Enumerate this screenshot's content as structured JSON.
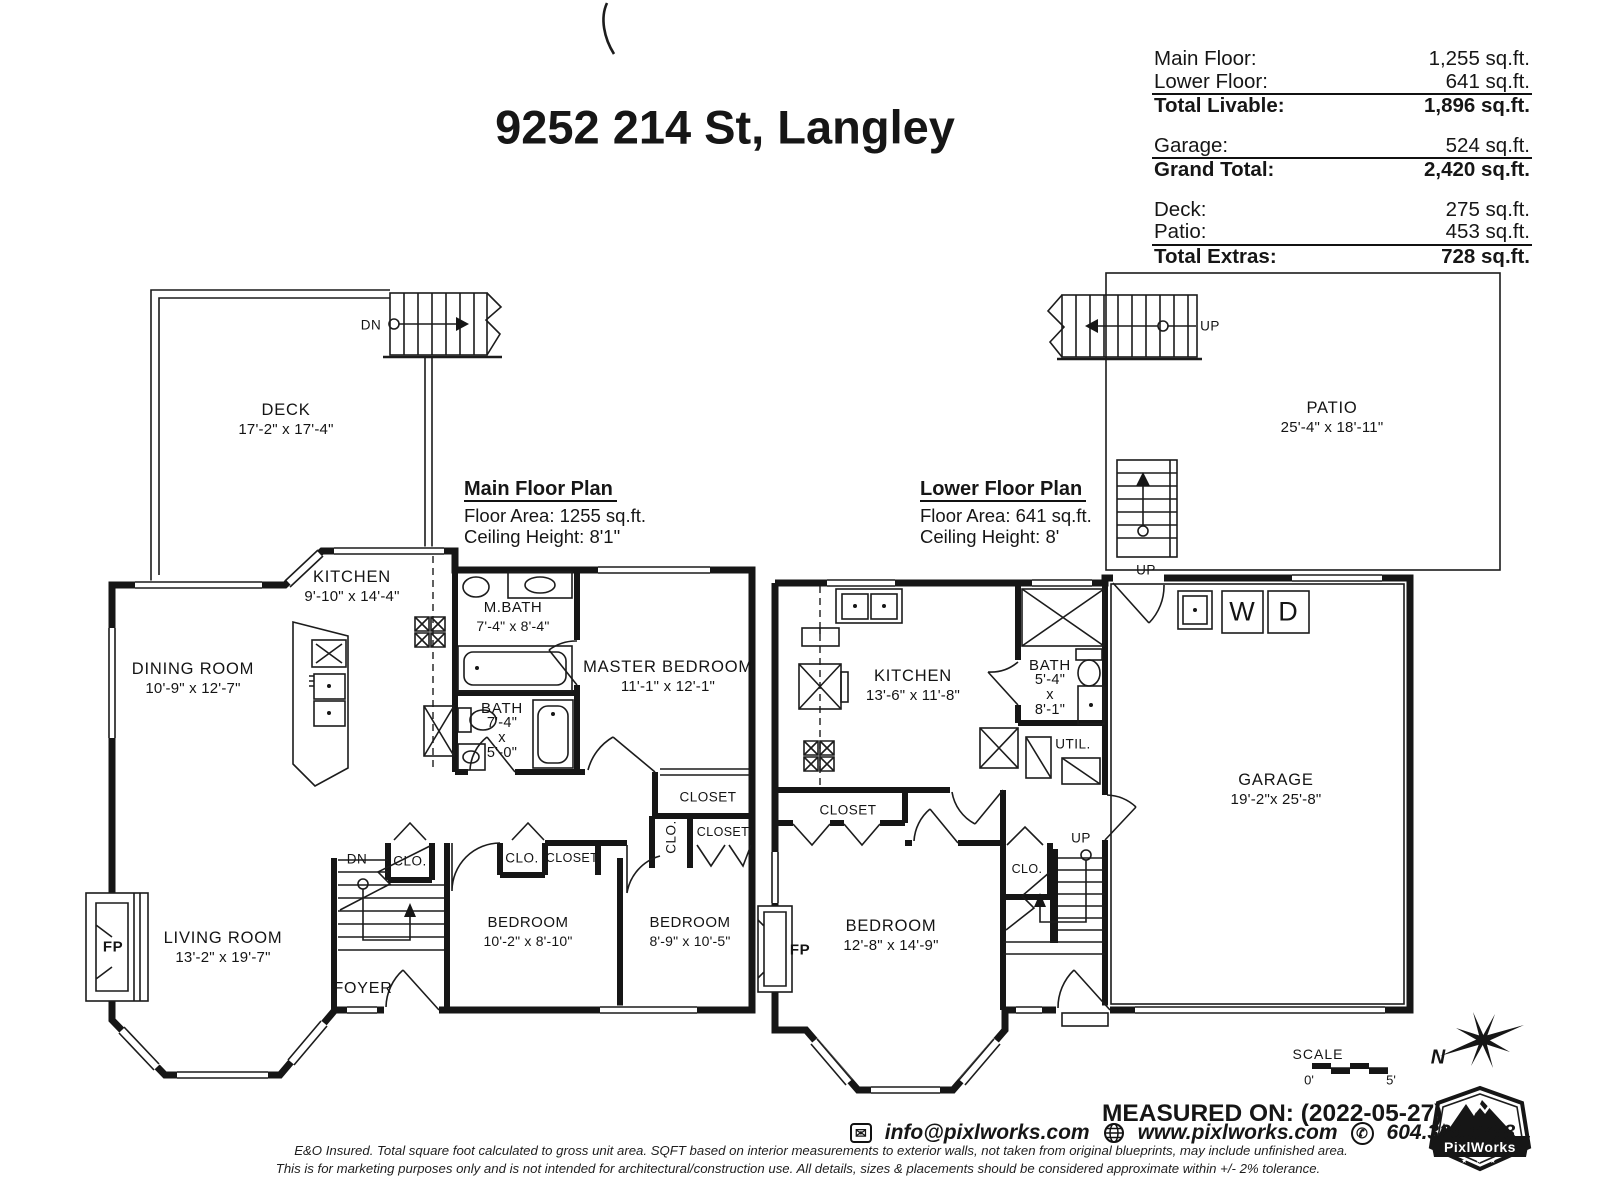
{
  "page": {
    "title": "9252 214 St, Langley"
  },
  "summary": {
    "rows": [
      {
        "label": "Main Floor:",
        "value": "1,255 sq.ft."
      },
      {
        "label": "Lower Floor:",
        "value": "641 sq.ft."
      },
      {
        "label": "Total Livable:",
        "value": "1,896 sq.ft."
      },
      {
        "label": "Garage:",
        "value": "524 sq.ft."
      },
      {
        "label": "Grand Total:",
        "value": "2,420 sq.ft."
      },
      {
        "label": "Deck:",
        "value": "275 sq.ft."
      },
      {
        "label": "Patio:",
        "value": "453 sq.ft."
      },
      {
        "label": "Total Extras:",
        "value": "728 sq.ft."
      }
    ]
  },
  "main_floor": {
    "heading": "Main Floor Plan",
    "floor_area": "Floor Area: 1255 sq.ft.",
    "ceiling_height": "Ceiling Height: 8'1\"",
    "rooms": {
      "deck": {
        "name": "DECK",
        "dims": "17'-2\" x 17'-4\""
      },
      "kitchen": {
        "name": "KITCHEN",
        "dims": "9'-10\" x 14'-4\""
      },
      "dining_room": {
        "name": "DINING ROOM",
        "dims": "10'-9\" x 12'-7\""
      },
      "m_bath": {
        "name": "M.BATH",
        "dims": "7'-4\" x 8'-4\""
      },
      "bath": {
        "name": "BATH",
        "dim_w": "7'-4\"",
        "dim_sep": "x",
        "dim_h": "5'-0\""
      },
      "master_bedroom": {
        "name": "MASTER BEDROOM",
        "dims": "11'-1\" x 12'-1\""
      },
      "living_room": {
        "name": "LIVING ROOM",
        "dims": "13'-2\" x 19'-7\""
      },
      "bedroom_a": {
        "name": "BEDROOM",
        "dims": "10'-2\" x 8'-10\""
      },
      "bedroom_b": {
        "name": "BEDROOM",
        "dims": "8'-9\" x 10'-5\""
      },
      "foyer": {
        "name": "FOYER"
      }
    }
  },
  "lower_floor": {
    "heading": "Lower Floor Plan",
    "floor_area": "Floor Area: 641 sq.ft.",
    "ceiling_height": "Ceiling Height: 8'",
    "rooms": {
      "patio": {
        "name": "PATIO",
        "dims": "25'-4\" x 18'-11\""
      },
      "kitchen": {
        "name": "KITCHEN",
        "dims": "13'-6\" x 11'-8\""
      },
      "bath": {
        "name": "BATH",
        "dim_w": "5'-4\"",
        "dim_sep": "x",
        "dim_h": "8'-1\""
      },
      "garage": {
        "name": "GARAGE",
        "dims": "19'-2\"x 25'-8\""
      },
      "bedroom": {
        "name": "BEDROOM",
        "dims": "12'-8\" x 14'-9\""
      }
    }
  },
  "tags": {
    "closet": "CLOSET",
    "clo": "CLO.",
    "dn": "DN",
    "up": "UP",
    "fp": "FP",
    "util": "UTIL.",
    "washer": "W",
    "dryer": "D"
  },
  "scale": {
    "label": "SCALE",
    "start": "0'",
    "end": "5'"
  },
  "compass": {
    "north": "N"
  },
  "footer": {
    "measured_on": "MEASURED ON: (2022-05-27)",
    "email": "info@pixlworks.com",
    "website": "www.pixlworks.com",
    "phone": "604.329.5788",
    "disclaimer_line1": "E&O Insured.  Total square foot calculated to gross unit area. SQFT based on interior measurements to exterior walls, not taken from original blueprints, may include unfinished area.",
    "disclaimer_line2": "This is for marketing purposes only and is not intended for architectural/construction use.  All details, sizes & placements should be considered approximate within +/- 2%  tolerance.",
    "brand": "PixlWorks",
    "brand_stars": "★ ★ ★"
  }
}
